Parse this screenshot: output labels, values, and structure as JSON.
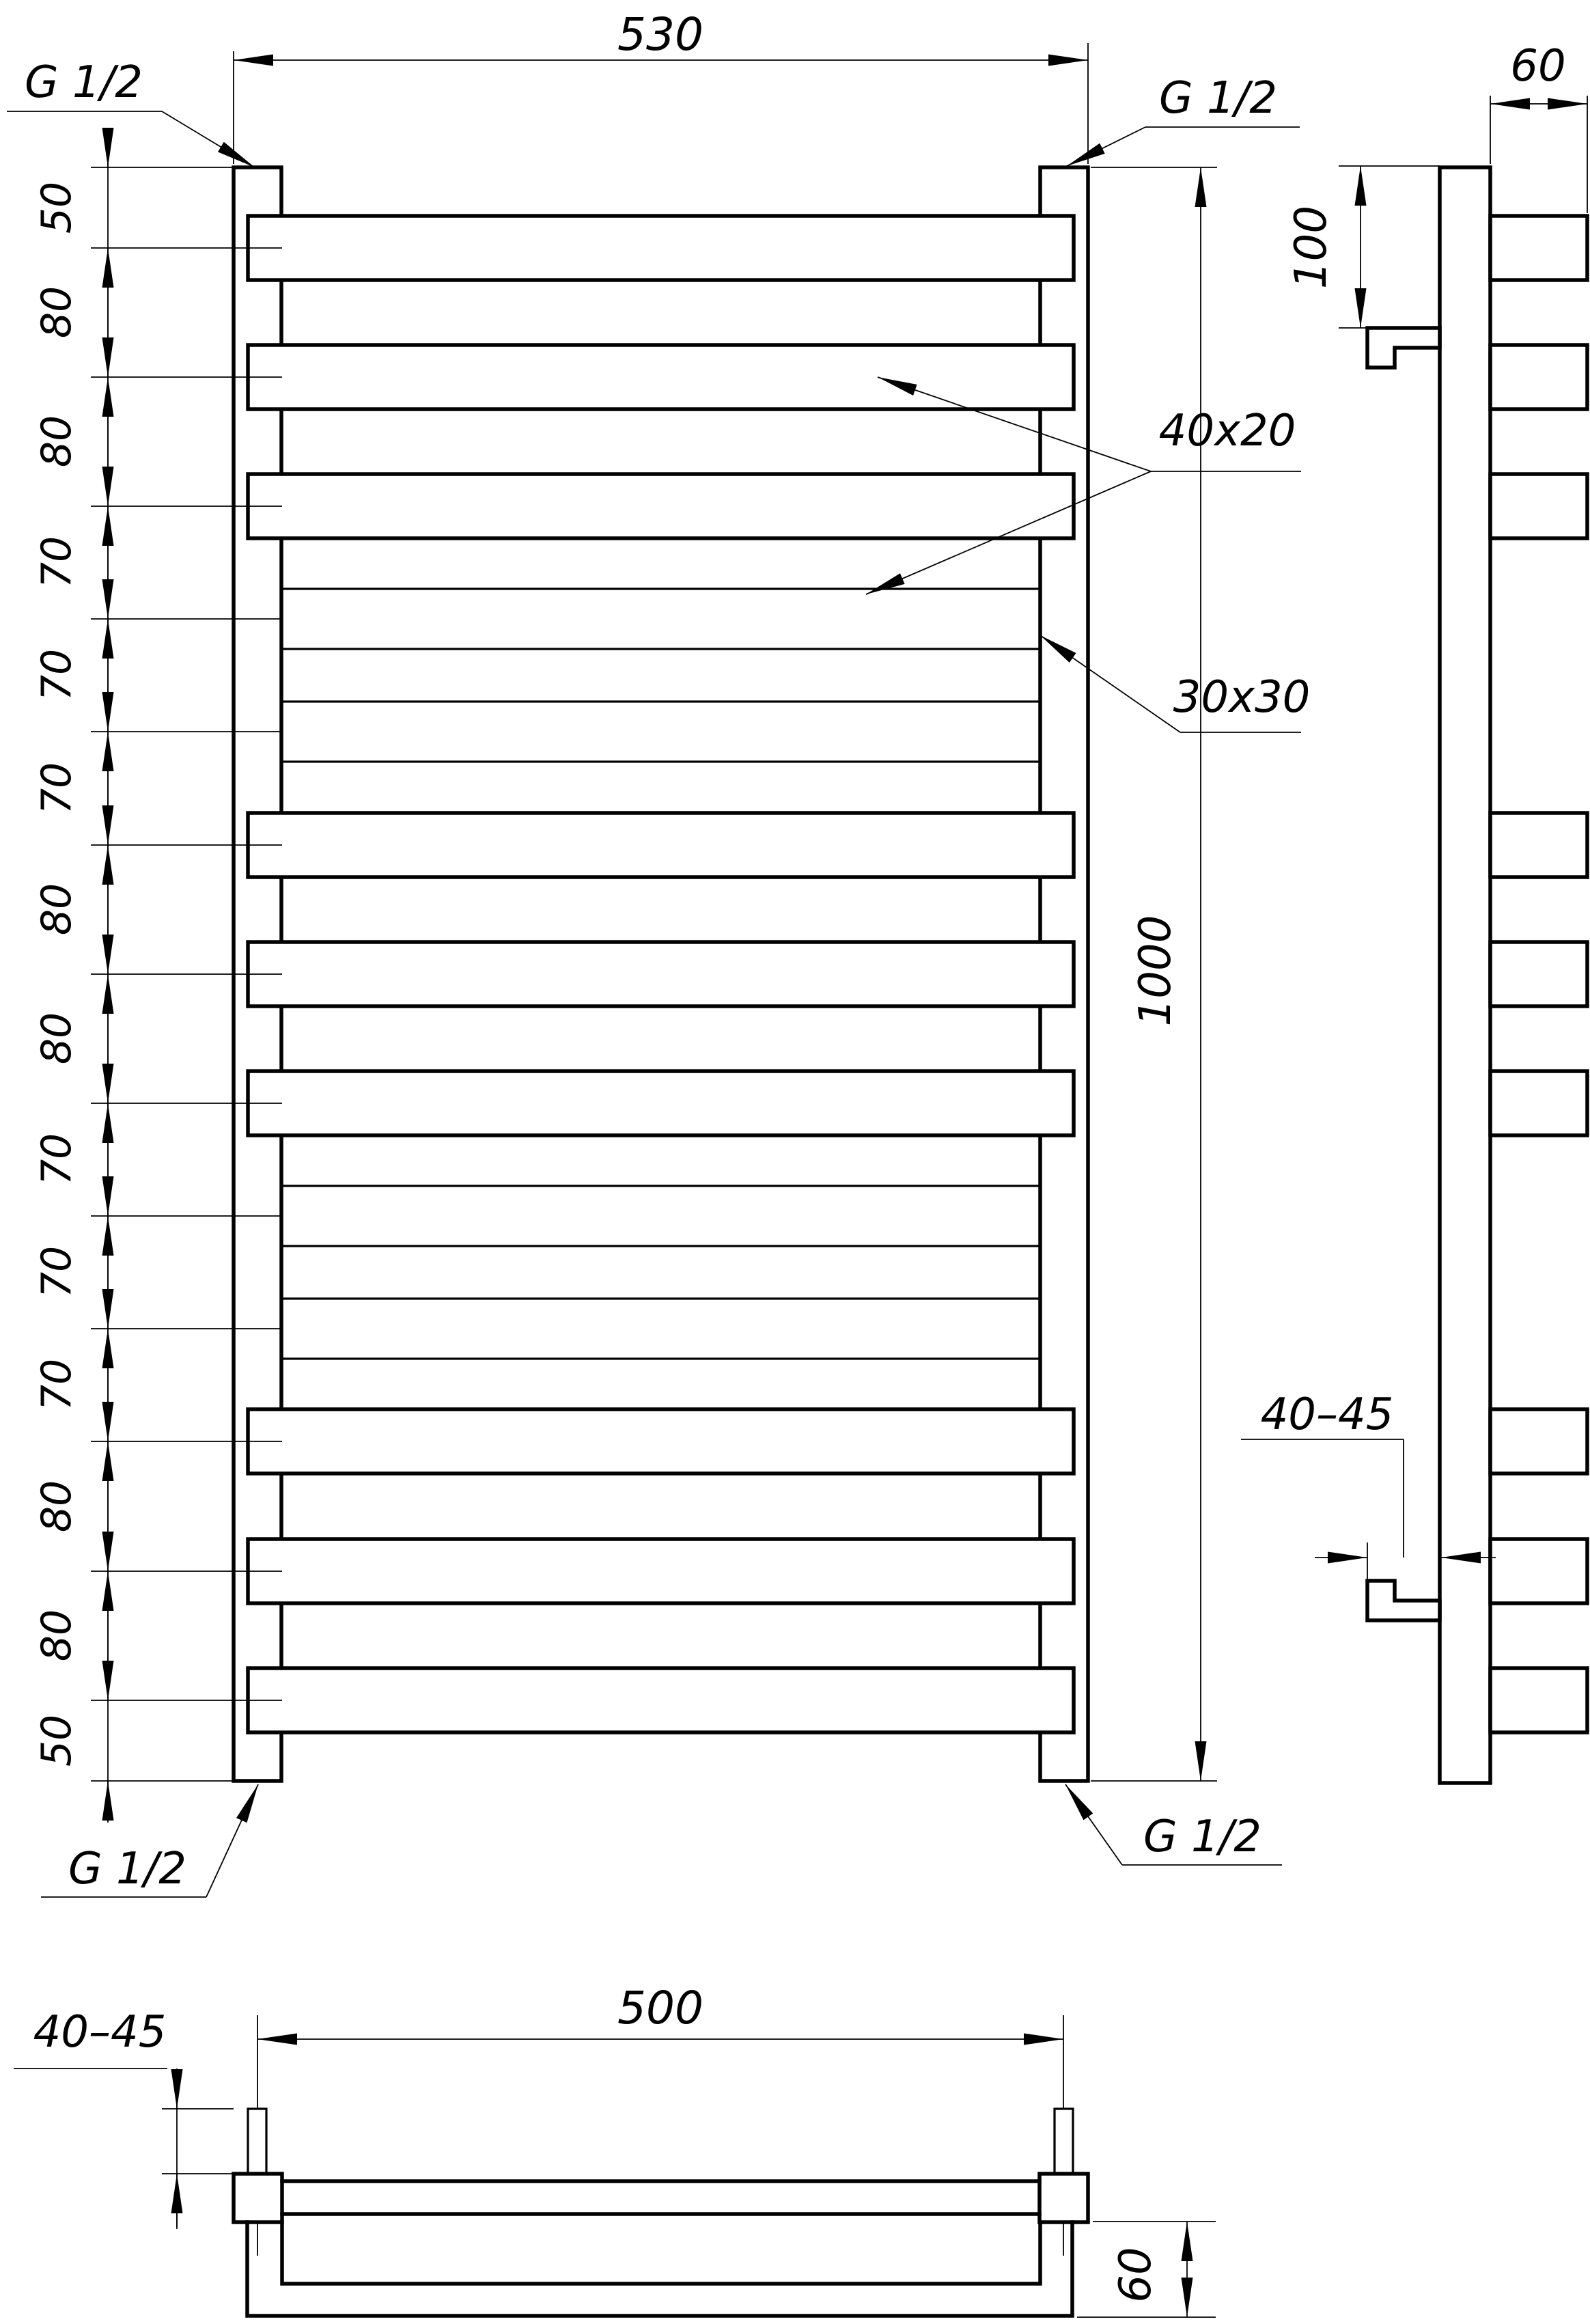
{
  "page": {
    "background": "#ffffff",
    "line_color": "#000000"
  },
  "front_view": {
    "width_dim": "530",
    "height_dim": "1000",
    "thread_label": "G 1/2",
    "rung_profile_label": "40x20",
    "collector_profile_label": "30x30",
    "spacing_chain": [
      "50",
      "80",
      "80",
      "70",
      "70",
      "70",
      "80",
      "80",
      "70",
      "70",
      "70",
      "80",
      "80",
      "50"
    ]
  },
  "side_view": {
    "rung_depth_dim": "60",
    "bracket_top_offset_dim": "100",
    "wall_clearance_dim": "40–45"
  },
  "bottom_view": {
    "connection_spacing_dim": "500",
    "wall_clearance_dim": "40–45",
    "depth_dim": "60"
  }
}
